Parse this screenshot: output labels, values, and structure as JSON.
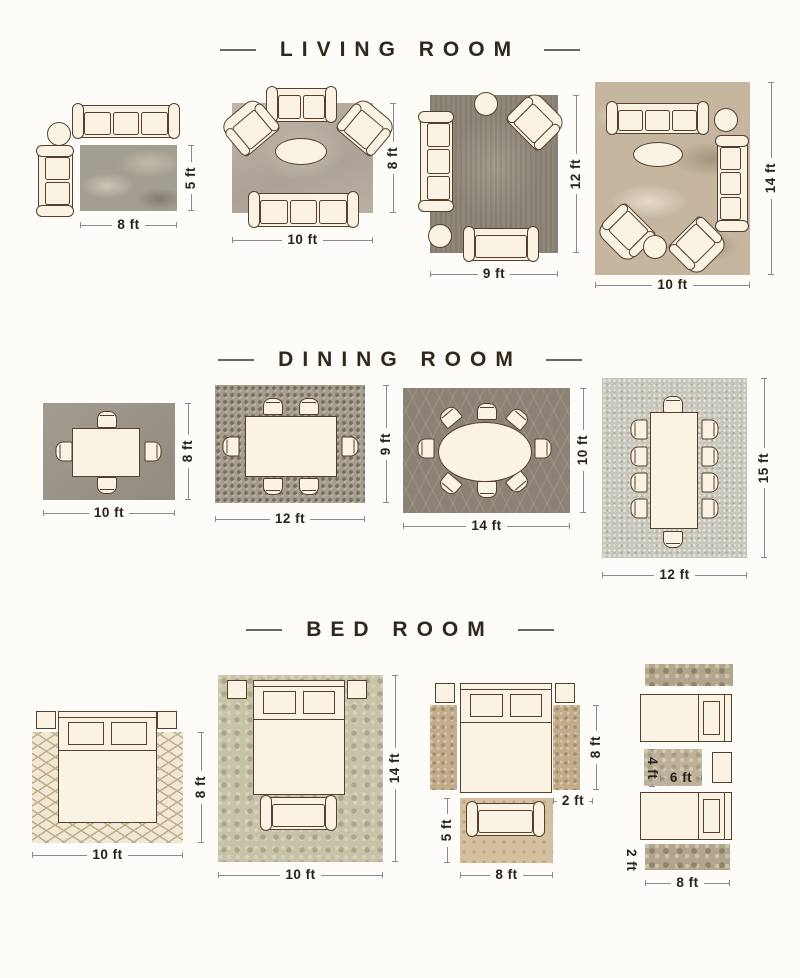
{
  "palette": {
    "page_bg": "#fdfcf8",
    "ink": "#2a211a",
    "title": "#32271c",
    "line": "#8b8b8b",
    "furn_fill": "#faf3e3",
    "furn_line": "#54402d",
    "rug_lr1": "#a39e92",
    "rug_lr2": "#b6ada0",
    "rug_lr3": "#8e8779",
    "rug_lr4": "#c6b6a0",
    "rug_dr1": "#9b958a",
    "rug_dr2": "#a59e90",
    "rug_dr3": "#8b8275",
    "rug_dr4": "#c7c7bb",
    "rug_br1": "#f1e8d3",
    "rug_br1_line": "#bfae8e",
    "rug_br2": "#c7c3a9",
    "rug_br3_runner": "#c2ac8d",
    "rug_br3_foot": "#d4c0a0",
    "rug_br4_runner": "#b1a68d",
    "rug_br4_mid": "#bcb29b"
  },
  "sections": [
    {
      "title": "LIVING ROOM",
      "layouts": [
        {
          "w": "8 ft",
          "h": "5 ft"
        },
        {
          "w": "10 ft",
          "h": "8 ft"
        },
        {
          "w": "9 ft",
          "h": "12 ft"
        },
        {
          "w": "10 ft",
          "h": "14 ft"
        }
      ]
    },
    {
      "title": "DINING ROOM",
      "layouts": [
        {
          "w": "10 ft",
          "h": "8 ft"
        },
        {
          "w": "12 ft",
          "h": "9 ft"
        },
        {
          "w": "14 ft",
          "h": "10 ft"
        },
        {
          "w": "12 ft",
          "h": "15 ft"
        }
      ]
    },
    {
      "title": "BED ROOM",
      "layouts": [
        {
          "w": "10 ft",
          "h": "8 ft"
        },
        {
          "w": "10 ft",
          "h": "14 ft"
        },
        {
          "runner_h": "8 ft",
          "runner_w": "2 ft",
          "foot_h": "5 ft",
          "foot_w": "8 ft"
        },
        {
          "mid_h": "4 ft",
          "mid_w": "6 ft",
          "runner_w": "2 ft",
          "runner_l": "8 ft"
        }
      ]
    }
  ]
}
